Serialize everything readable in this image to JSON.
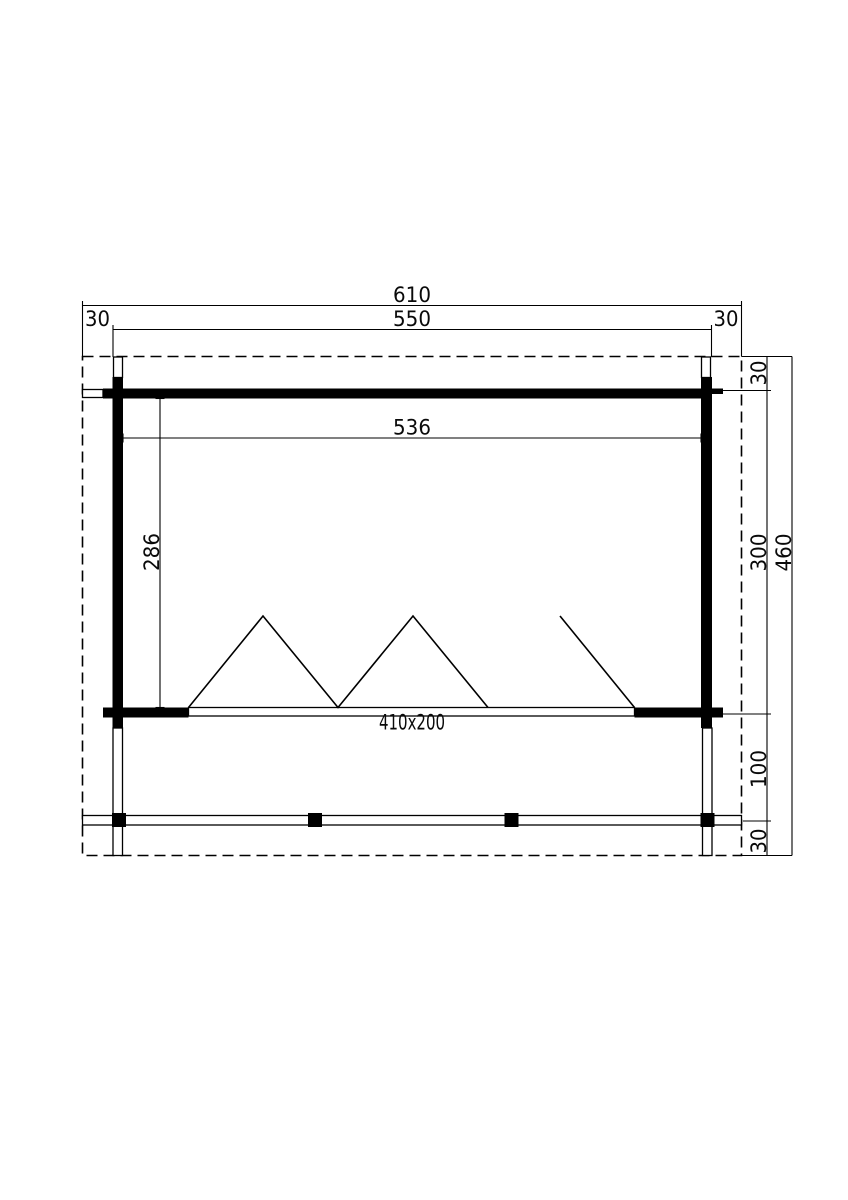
{
  "meta": {
    "background_color": "#ffffff",
    "line_color": "#000000",
    "drawing_type": "floor-plan-top-view"
  },
  "drawing": {
    "dimensions": {
      "total_width": "610",
      "wall_outer_width": "550",
      "overhang_left": "30",
      "overhang_right": "30",
      "inner_width": "536",
      "inner_depth": "286",
      "overhang_top": "30",
      "building_depth": "300",
      "porch_depth": "100",
      "overhang_bottom": "30",
      "total_depth": "460",
      "door_opening_size": "410x200"
    }
  }
}
